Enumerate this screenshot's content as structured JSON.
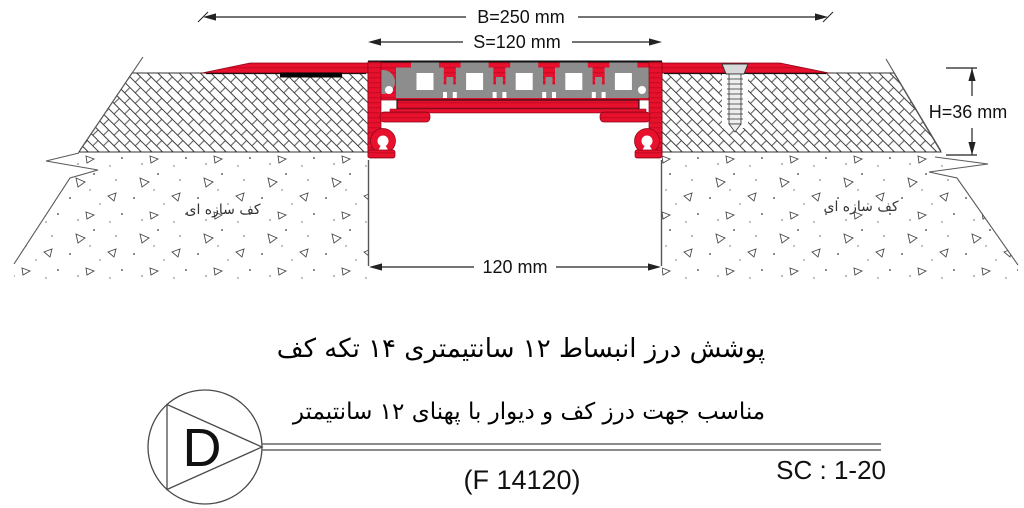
{
  "drawing": {
    "dim_b": "B=250 mm",
    "dim_s": "S=120 mm",
    "dim_h": "H=36 mm",
    "dim_joint": "120 mm",
    "floor_label_left": "کف سازه ای",
    "floor_label_right": "کف سازه ای"
  },
  "captions": {
    "line1": "پوشش درز انبساط ۱۲ سانتیمتری ۱۴ تکه کف",
    "line2": "مناسب جهت درز کف و دیوار با  پهنای ۱۲ سانتیمتر"
  },
  "detail_marker": {
    "letter": "D"
  },
  "footer": {
    "product_code": "(F 14120)",
    "scale": "SC : 1-20"
  },
  "colors": {
    "profile_red": "#e8112d",
    "profile_red_dark": "#b5071f",
    "insert_gray": "#8d8d8d",
    "line_black": "#222222"
  }
}
